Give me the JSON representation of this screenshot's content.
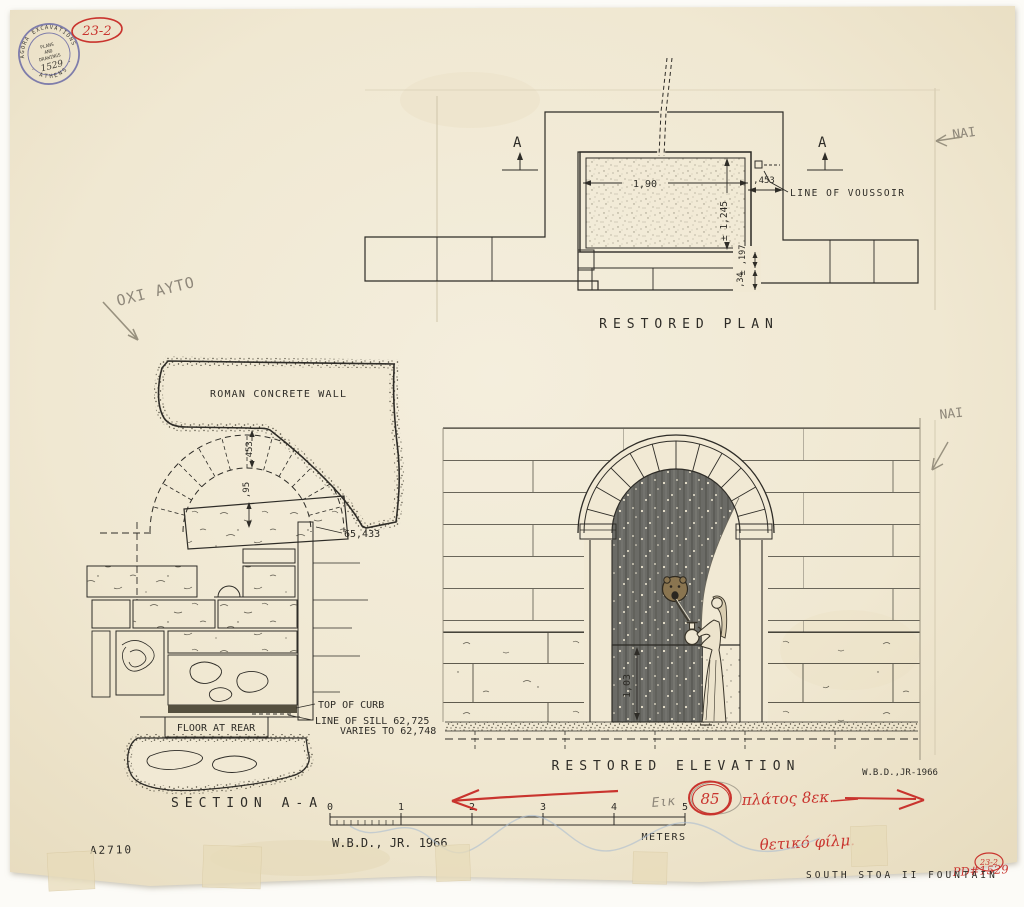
{
  "stamp": {
    "arc_top": "AGORA EXCAVATIONS",
    "arc_bottom": "· ATHENS ·",
    "line1": "PLANS",
    "line2": "AND",
    "line3": "DRAWINGS",
    "number": "1529"
  },
  "red_notes": {
    "code_top_left": "23-2",
    "figure_circle": "85",
    "width_note": "πλάτος 8εκ.",
    "film_note": "θετικό φίλμ.",
    "pd_number": "PD#1529",
    "code_bottom_right": "23-2"
  },
  "pencil_notes": {
    "not_this": "ΟΧΙ ΑΥΤΟ",
    "yes_upper": "NAI",
    "yes_lower": "NAI",
    "fig_abbrev": "Εικ",
    "subject": "SOUTH STOA II FOUNTAIN",
    "negative_number": "A2710"
  },
  "plan": {
    "title": "RESTORED PLAN",
    "marker_left": "A",
    "marker_right": "A",
    "dim_width": "1,90",
    "dim_depth": "± 1,245",
    "dim_wall": ",453",
    "dim_sill": "± ,197",
    "dim_step": ",34",
    "voussoir_label": "LINE OF VOUSSOIR"
  },
  "section": {
    "title": "SECTION A-A",
    "wall_label": "ROMAN CONCRETE WALL",
    "dim_arch": ",453",
    "dim_gap": ",95",
    "elevation_mark": "65,433",
    "curb_label": "TOP OF CURB",
    "sill_line1": "LINE OF SILL 62,725",
    "sill_line2": "VARIES TO 62,748",
    "floor_label": "FLOOR AT REAR"
  },
  "elevation": {
    "title": "RESTORED ELEVATION",
    "dim_height": "1,03",
    "signature": "W.B.D.,JR-1966"
  },
  "scalebar": {
    "t0": "0",
    "t1": "1",
    "t2": "2",
    "t3": "3",
    "t4": "4",
    "t5": "5",
    "unit": "METERS",
    "credit": "W.B.D., JR.  1966"
  }
}
